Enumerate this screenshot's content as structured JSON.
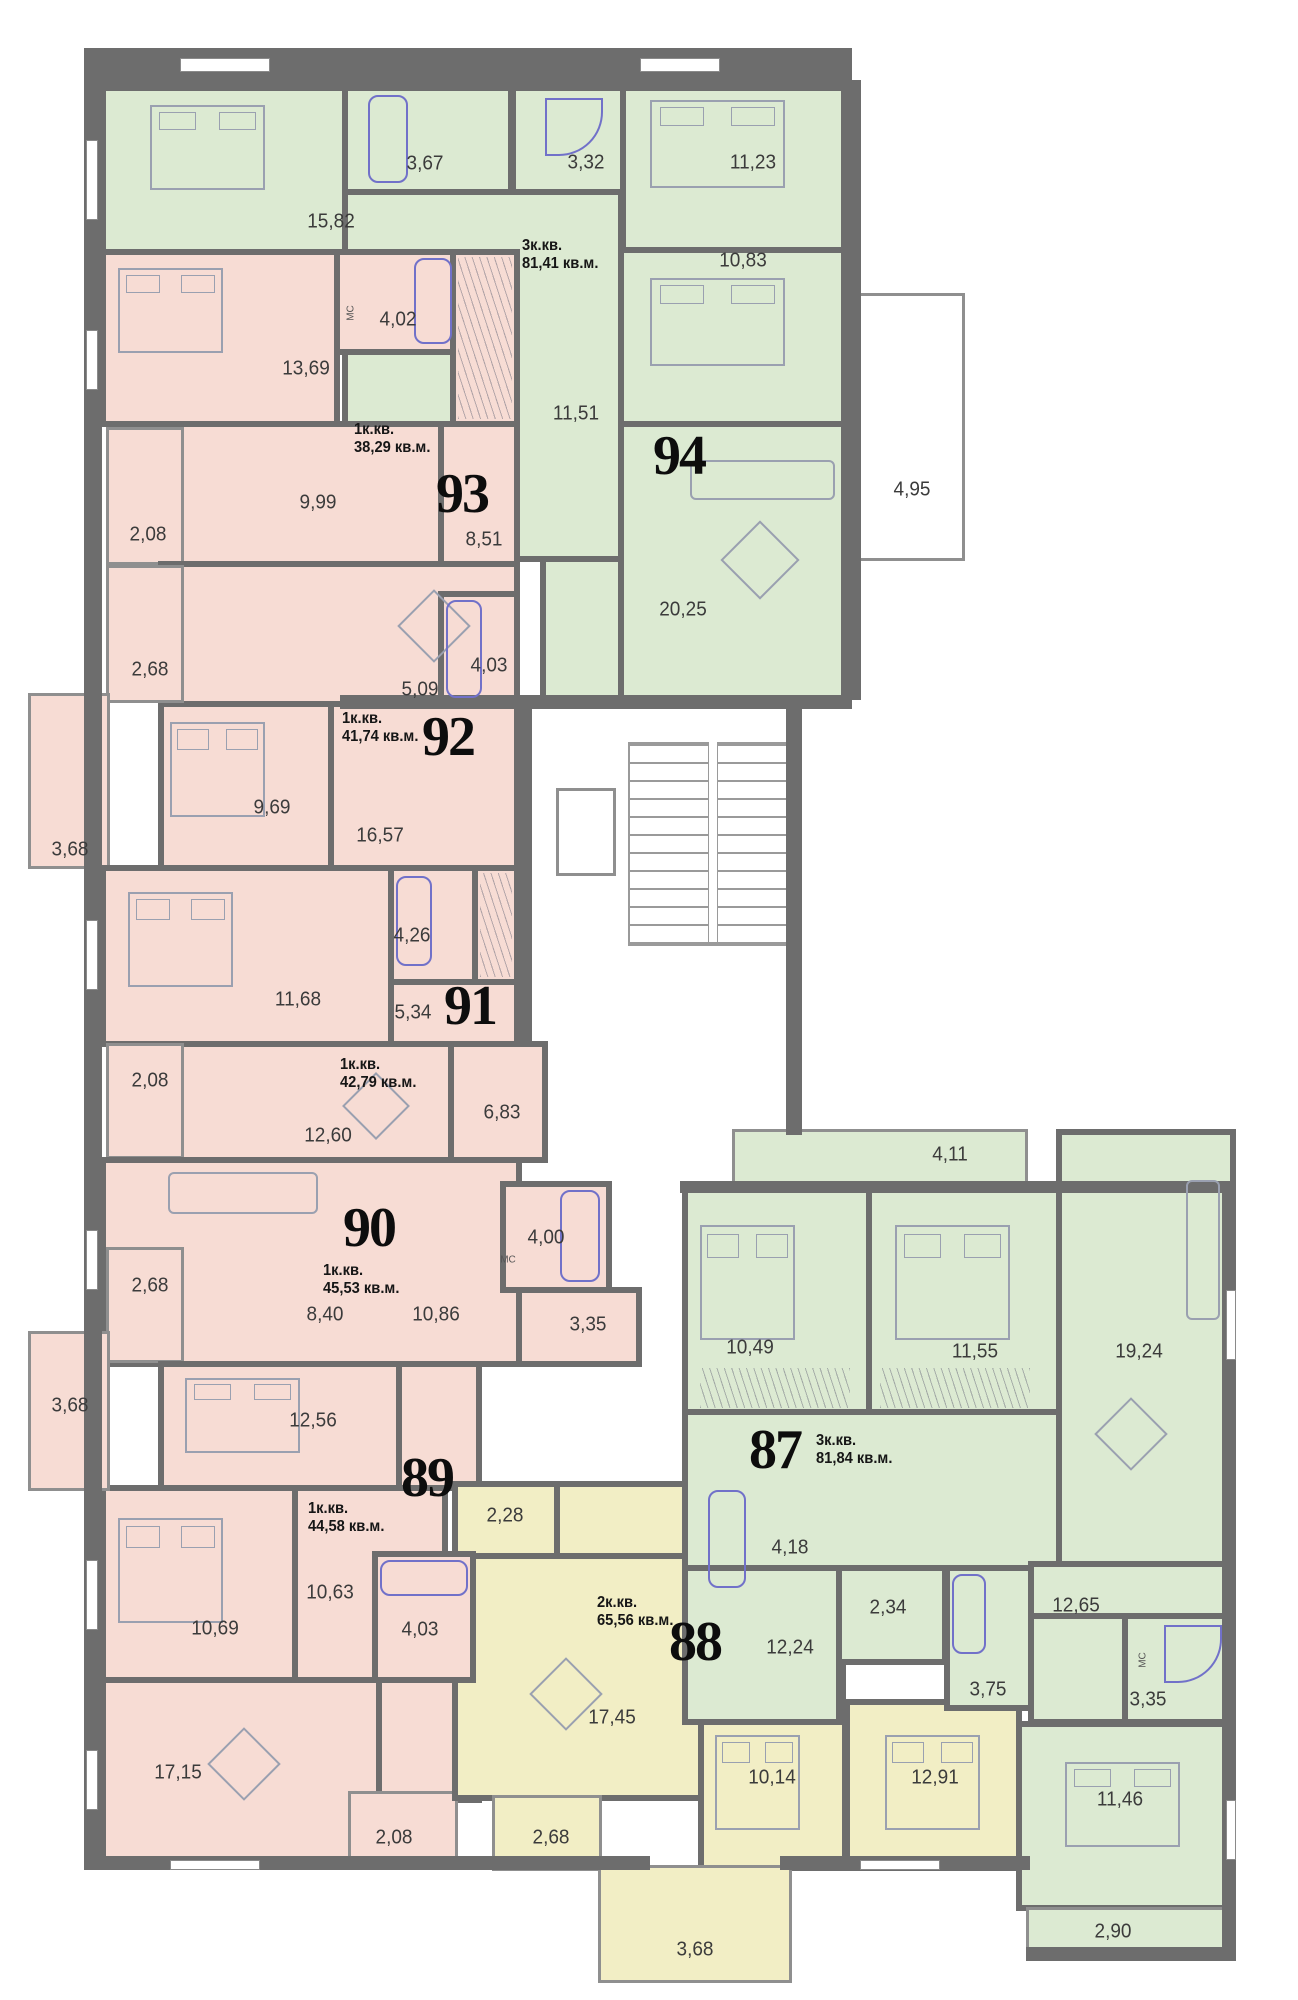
{
  "colors": {
    "wall": "#6d6d6d",
    "apartment_green": "#dcead2",
    "apartment_pink": "#f7dcd4",
    "apartment_yellow": "#f2eec5",
    "fixture_blue": "#7171c9"
  },
  "mc_label": "МС",
  "apartments": [
    {
      "number": "94",
      "type_line": "3к.кв.",
      "area_line": "81,41 кв.м.",
      "rooms": [
        "15,82",
        "3,67",
        "3,32",
        "11,23",
        "10,83",
        "11,51",
        "20,25",
        "4,95"
      ]
    },
    {
      "number": "93",
      "type_line": "1к.кв.",
      "area_line": "38,29 кв.м.",
      "rooms": [
        "13,69",
        "4,02",
        "9,99",
        "8,51",
        "2,08"
      ]
    },
    {
      "number": "92",
      "type_line": "1к.кв.",
      "area_line": "41,74 кв.м.",
      "rooms": [
        "2,68",
        "9,69",
        "16,57",
        "5,09",
        "4,03",
        "3,68"
      ]
    },
    {
      "number": "91",
      "type_line": "1к.кв.",
      "area_line": "42,79 кв.м.",
      "rooms": [
        "11,68",
        "4,26",
        "5,34",
        "12,60",
        "6,83",
        "2,08"
      ]
    },
    {
      "number": "90",
      "type_line": "1к.кв.",
      "area_line": "45,53 кв.м.",
      "rooms": [
        "8,40",
        "10,86",
        "4,00",
        "3,35",
        "2,68"
      ]
    },
    {
      "number": "89",
      "type_line": "1к.кв.",
      "area_line": "44,58 кв.м.",
      "rooms": [
        "12,56",
        "10,69",
        "10,63",
        "4,03",
        "17,15",
        "2,08",
        "3,68"
      ]
    },
    {
      "number": "88",
      "type_line": "2к.кв.",
      "area_line": "65,56 кв.м.",
      "rooms": [
        "2,28",
        "4,18",
        "12,24",
        "17,45",
        "10,14",
        "12,91",
        "2,68",
        "3,68"
      ]
    },
    {
      "number": "87",
      "type_line": "3к.кв.",
      "area_line": "81,84 кв.м.",
      "rooms": [
        "4,11",
        "10,49",
        "11,55",
        "19,24",
        "2,34",
        "3,75",
        "12,65",
        "3,35",
        "11,46",
        "2,90"
      ]
    }
  ]
}
